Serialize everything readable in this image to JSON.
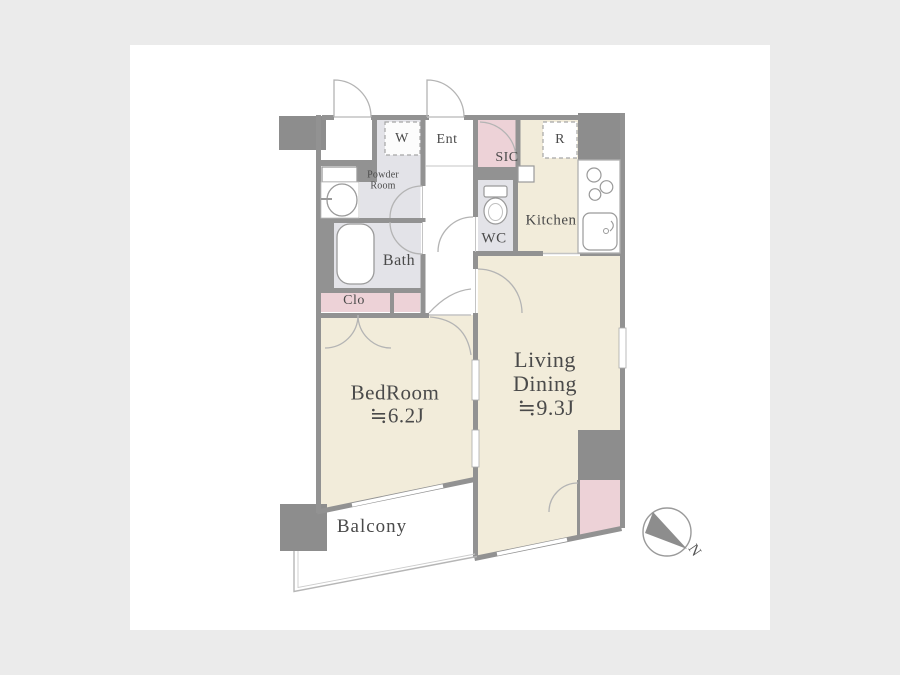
{
  "rooms": {
    "bedroom": {
      "label": "BedRoom",
      "size": "≒6.2J"
    },
    "living_dining": {
      "line1": "Living",
      "line2": "Dining",
      "size": "≒9.3J"
    },
    "balcony": {
      "label": "Balcony"
    },
    "kitchen": {
      "label": "Kitchen"
    },
    "bath": {
      "label": "Bath"
    },
    "wc": {
      "label": "WC"
    },
    "powder_room": {
      "line1": "Powder",
      "line2": "Room"
    },
    "entrance": {
      "label": "Ent"
    },
    "sic": {
      "label": "SIC"
    },
    "closet": {
      "label": "Clo"
    },
    "washer": {
      "label": "W"
    },
    "refrigerator": {
      "label": "R"
    }
  },
  "compass": {
    "label": "N"
  },
  "colors": {
    "page_bg": "#ebebeb",
    "card_bg": "#ffffff",
    "wall": "#929292",
    "pillar": "#8d8d8d",
    "floor_beige": "#f2ecda",
    "floor_gray": "#e3e3e8",
    "floor_pink": "#edd2d7",
    "fixture_stroke": "#9a9a9a",
    "text": "#4a4a4a"
  }
}
